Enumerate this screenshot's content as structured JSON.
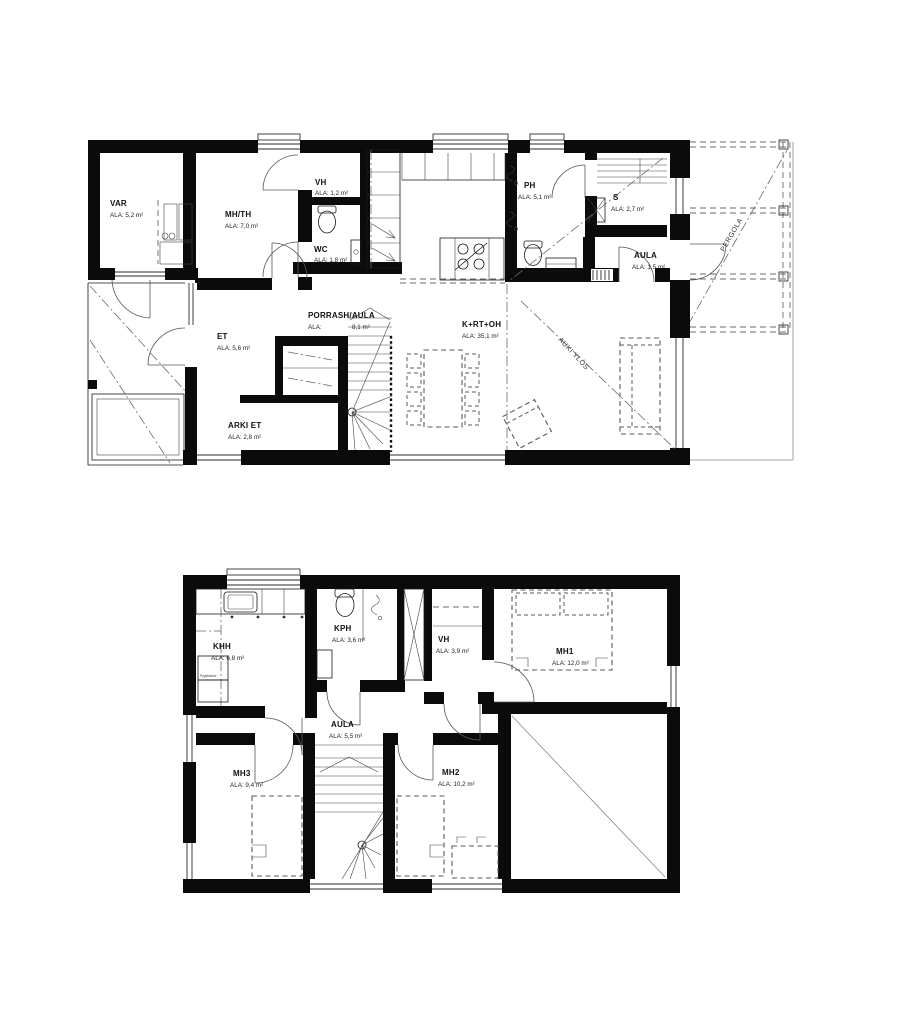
{
  "document": {
    "type": "floor-plan-drawing",
    "floors": 2
  },
  "floor1": {
    "rooms": {
      "var": {
        "name": "VAR",
        "area": "ALA: 5,2 m²"
      },
      "mhth": {
        "name": "MH/TH",
        "area": "ALA: 7,0 m²"
      },
      "vh": {
        "name": "VH",
        "area": "ALA: 1,2 m²"
      },
      "wc": {
        "name": "WC",
        "area": "ALA: 1,8 m²"
      },
      "porras": {
        "name": "PORRASH/AULA",
        "area_label": "ALA:",
        "area_value": "8,1 m²"
      },
      "et": {
        "name": "ET",
        "area": "ALA: 5,6 m²"
      },
      "arkiet": {
        "name": "ARKI ET",
        "area": "ALA: 2,8 m²"
      },
      "krtoh": {
        "name": "K+RT+OH",
        "area": "ALA: 35,1 m²"
      },
      "ph": {
        "name": "PH",
        "area": "ALA: 5,1 m²"
      },
      "s": {
        "name": "S",
        "area": "ALA: 2,7 m²"
      },
      "aula": {
        "name": "AULA",
        "area": "ALA: 1,5 m²"
      }
    },
    "annotations": {
      "pergola": "PERGOLA",
      "auki_ylos": "AUKI YLÖS"
    }
  },
  "floor2": {
    "rooms": {
      "khh": {
        "name": "KHH",
        "area": "ALA: 6,8 m²"
      },
      "kph": {
        "name": "KPH",
        "area": "ALA: 3,6 m²"
      },
      "vh": {
        "name": "VH",
        "area": "ALA: 3,9 m²"
      },
      "aula": {
        "name": "AULA",
        "area": "ALA: 5,5 m²"
      },
      "mh1": {
        "name": "MH1",
        "area": "ALA: 12,0 m²"
      },
      "mh2": {
        "name": "MH2",
        "area": "ALA: 10,2 m²"
      },
      "mh3": {
        "name": "MH3",
        "area": "ALA: 9,4 m²"
      }
    },
    "annotations": {
      "laundry_tower": "Pyykkitorni"
    }
  }
}
